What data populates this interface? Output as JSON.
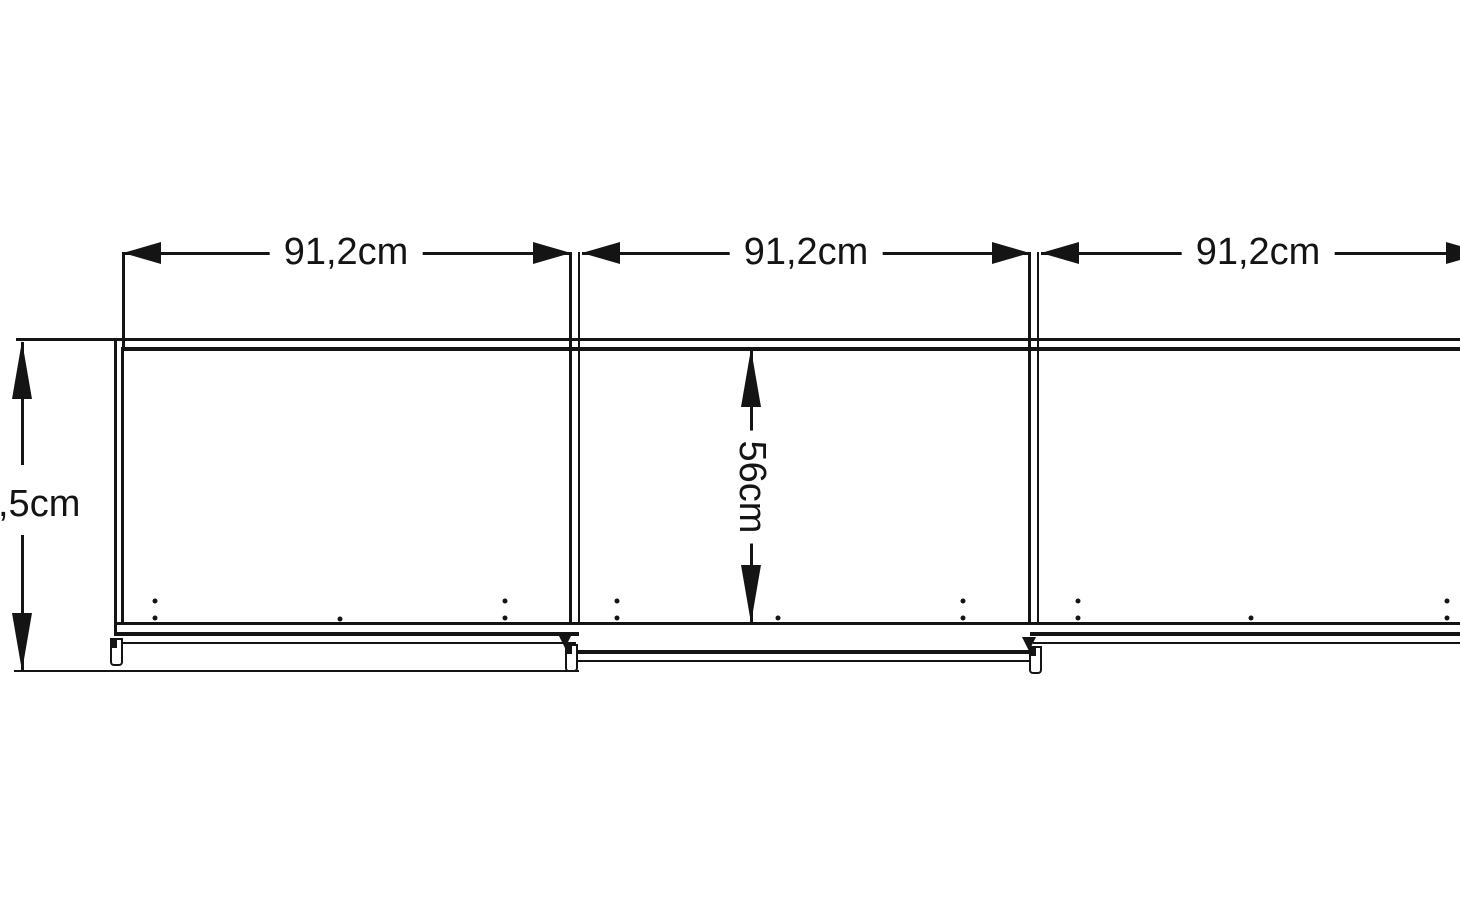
{
  "diagram": {
    "title": "Sliding-door wardrobe front elevation with dimensions",
    "dimensions": {
      "door_width_1": "91,2cm",
      "door_width_2": "91,2cm",
      "door_width_3": "91,2cm",
      "overall_height_partial": ",5cm",
      "inner_height": "56cm"
    },
    "colors": {
      "line": "#141414",
      "background": "#ffffff"
    }
  }
}
